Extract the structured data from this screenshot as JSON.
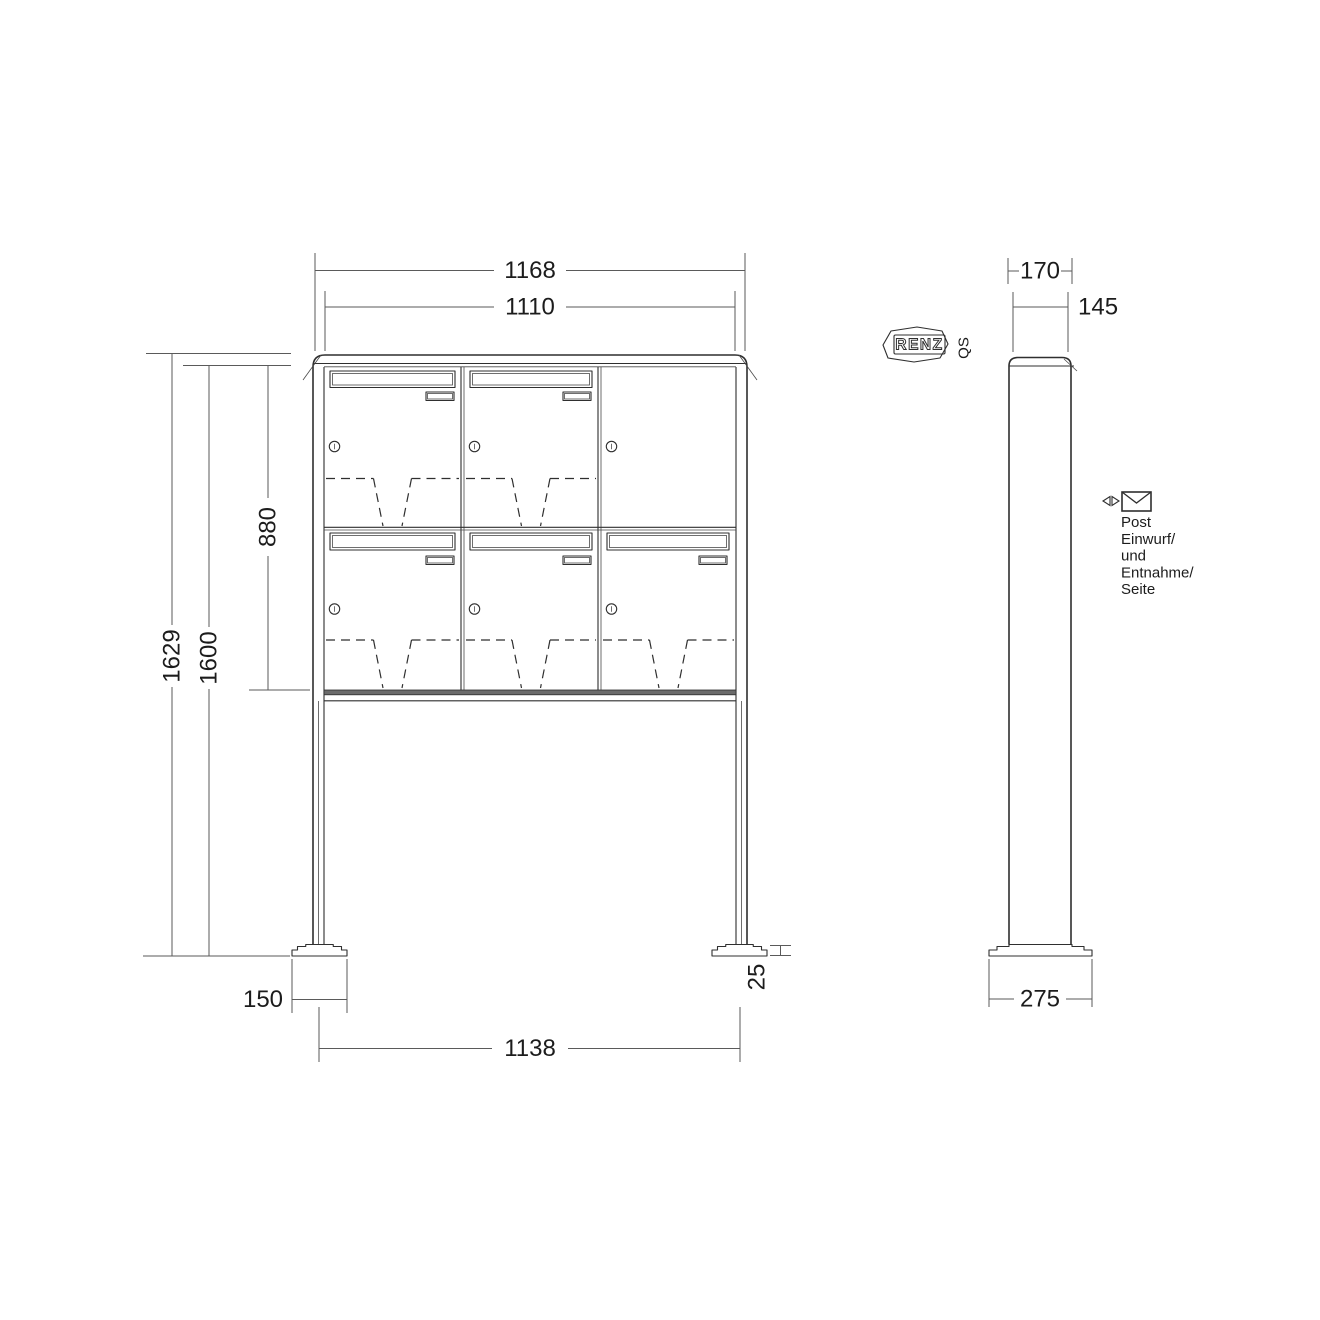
{
  "logo": {
    "brand": "RENZ",
    "qs_mark": "QS"
  },
  "dimensions": {
    "front": {
      "overall_width": "1168",
      "box_bank_width": "1110",
      "overall_height": "1629",
      "post_height": "1600",
      "box_bank_height": "880",
      "foot_plate_width": "150",
      "foot_spacing": "1138",
      "foot_plate_height": "25"
    },
    "side": {
      "overall_depth": "170",
      "box_depth": "145",
      "foot_plate_depth": "275"
    }
  },
  "annotation": {
    "lines": [
      "Post",
      "Einwurf/",
      "und",
      "Entnahme/",
      "Seite"
    ]
  },
  "colors": {
    "line": "#2f2f2f",
    "thin": "#4a4a4a",
    "dim": "#5a5a5a",
    "text": "#1c1c1c",
    "band": "#6b6b6b",
    "background": "#ffffff"
  }
}
